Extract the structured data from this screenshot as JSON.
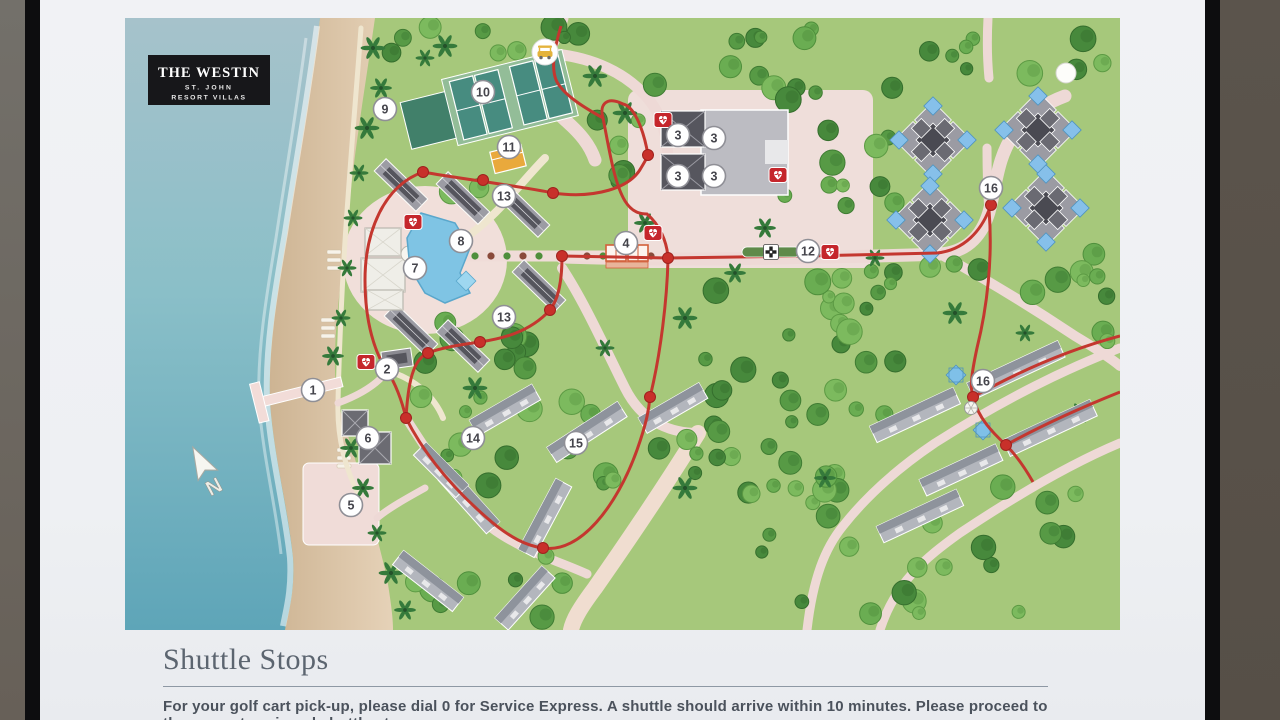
{
  "sign": {
    "logo": {
      "line1": "THE WESTIN",
      "line2": "ST. JOHN",
      "line3": "RESORT VILLAS"
    },
    "footer": {
      "heading": "Shuttle Stops",
      "body": "For your golf cart pick-up, please dial 0 for Service Express. A shuttle should arrive within 10 minutes. Please proceed to the nearest assigned shuttle stop."
    }
  },
  "map": {
    "shuttle_stops": [
      {
        "label": "1",
        "x": 188,
        "y": 372
      },
      {
        "label": "2",
        "x": 262,
        "y": 351
      },
      {
        "label": "3",
        "x": 553,
        "y": 117
      },
      {
        "label": "3",
        "x": 589,
        "y": 120
      },
      {
        "label": "3",
        "x": 553,
        "y": 158
      },
      {
        "label": "3",
        "x": 589,
        "y": 158
      },
      {
        "label": "4",
        "x": 501,
        "y": 225
      },
      {
        "label": "5",
        "x": 226,
        "y": 487
      },
      {
        "label": "6",
        "x": 243,
        "y": 420
      },
      {
        "label": "7",
        "x": 290,
        "y": 250
      },
      {
        "label": "8",
        "x": 336,
        "y": 223
      },
      {
        "label": "9",
        "x": 260,
        "y": 91
      },
      {
        "label": "10",
        "x": 358,
        "y": 74
      },
      {
        "label": "11",
        "x": 384,
        "y": 129
      },
      {
        "label": "12",
        "x": 683,
        "y": 233
      },
      {
        "label": "13",
        "x": 379,
        "y": 178
      },
      {
        "label": "13",
        "x": 379,
        "y": 299
      },
      {
        "label": "14",
        "x": 348,
        "y": 420
      },
      {
        "label": "15",
        "x": 451,
        "y": 425
      },
      {
        "label": "16",
        "x": 866,
        "y": 170
      },
      {
        "label": "16",
        "x": 858,
        "y": 363
      }
    ],
    "aed_locations": [
      [
        538,
        102
      ],
      [
        653,
        157
      ],
      [
        528,
        215
      ],
      [
        705,
        234
      ],
      [
        288,
        204
      ],
      [
        241,
        344
      ]
    ],
    "stop_dots": [
      [
        298,
        154
      ],
      [
        358,
        162
      ],
      [
        428,
        175
      ],
      [
        523,
        137
      ],
      [
        437,
        238
      ],
      [
        543,
        240
      ],
      [
        425,
        292
      ],
      [
        355,
        324
      ],
      [
        303,
        335
      ],
      [
        281,
        400
      ],
      [
        262,
        353
      ],
      [
        418,
        530
      ],
      [
        525,
        379
      ],
      [
        866,
        187
      ],
      [
        848,
        379
      ],
      [
        881,
        427
      ]
    ],
    "icons": {
      "golf_cart_pickup": {
        "x": 420,
        "y": 34
      },
      "crosswalk": {
        "x": 646,
        "y": 234
      },
      "north_arrow": {
        "x": 80,
        "y": 452,
        "label": "N"
      },
      "stickers": [
        [
          50,
          54
        ],
        [
          941,
          55
        ]
      ],
      "fountain": {
        "x": 846,
        "y": 390
      }
    },
    "colors": {
      "route": "#c4372f",
      "stop_dot": "#c8302a",
      "road": "#eed9d6",
      "walkway": "#efe6cf",
      "ocean_top": "#a6c2cb",
      "ocean_bottom": "#5ea5b8",
      "sand": "#dcc6aa",
      "land": "#a6c87b",
      "building": "#9c9ca4",
      "roof_dark": "#55555d",
      "pool": "#7fc4e4",
      "court": "#478c80",
      "lawn": "#41806a",
      "aed": "#c5262c",
      "marker_ring": "#8f8f96",
      "logo_bg": "#17171a"
    }
  }
}
